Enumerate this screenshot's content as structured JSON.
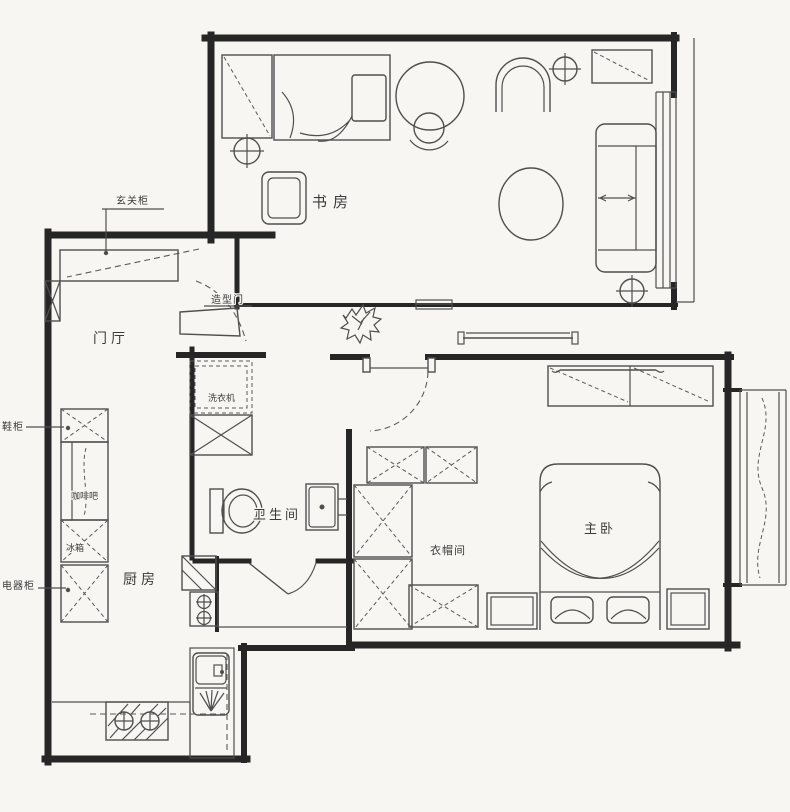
{
  "colors": {
    "paper": "#f7f6f3",
    "wall_ink": "#262626",
    "furniture_ink": "#4f4f4f",
    "label_ink": "#3b3b3b"
  },
  "rooms": {
    "study": {
      "label": "书房"
    },
    "entry_hall": {
      "label": "门厅"
    },
    "kitchen": {
      "label": "厨房"
    },
    "bathroom": {
      "label": "卫生间"
    },
    "cloakroom": {
      "label": "衣帽间"
    },
    "master_bedroom": {
      "label": "主卧"
    }
  },
  "annotations": {
    "entry_cabinet": {
      "label": "玄关柜"
    },
    "shaped_door": {
      "label": "造型门"
    },
    "shoe_cabinet": {
      "label": "鞋柜"
    },
    "coffee_bar": {
      "label": "咖啡吧"
    },
    "fridge": {
      "label": "冰箱"
    },
    "appliance_cabinet": {
      "label": "电器柜"
    },
    "washing_machine": {
      "label": "洗衣机"
    }
  }
}
